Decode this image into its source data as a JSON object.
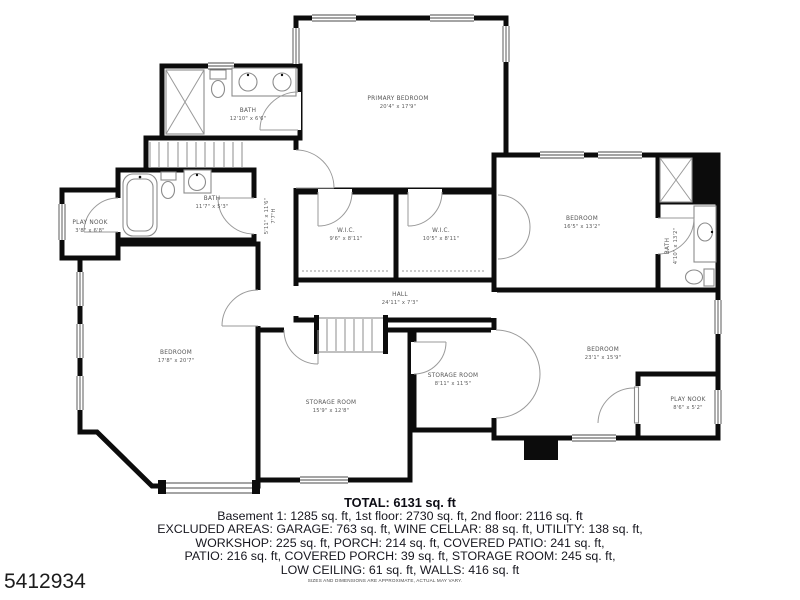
{
  "plan": {
    "wall_color": "#0c0c0c",
    "rooms": [
      {
        "name": "PRIMARY BEDROOM",
        "dims": "20'4\" x 17'9\""
      },
      {
        "name": "BATH",
        "dims": "12'10\" x 6'6\""
      },
      {
        "name": "BATH",
        "dims": "11'7\" x 5'3\""
      },
      {
        "name": "PLAY NOOK",
        "dims": "3'8\" x 6'8\""
      },
      {
        "name": "W.I.C.",
        "dims": "9'6\" x 8'11\""
      },
      {
        "name": "W.I.C.",
        "dims": "10'5\" x 8'11\""
      },
      {
        "name": "HALL",
        "dims": "24'11\" x 7'3\""
      },
      {
        "name": "BEDROOM",
        "dims": "16'5\" x 13'2\""
      },
      {
        "name": "BATH",
        "dims": "4'10\" x 13'2\""
      },
      {
        "name": "BEDROOM",
        "dims": "17'8\" x 20'7\""
      },
      {
        "name": "STORAGE ROOM",
        "dims": "15'9\" x 12'8\""
      },
      {
        "name": "STORAGE ROOM",
        "dims": "8'11\" x 11'5\""
      },
      {
        "name": "BEDROOM",
        "dims": "23'1\" x 15'9\""
      },
      {
        "name": "PLAY NOOK",
        "dims": "8'6\" x 5'2\""
      }
    ],
    "stair_note": {
      "line1": "5'11\" x 11'6\"",
      "line2": "7'7\"H"
    }
  },
  "summary": {
    "total": "TOTAL: 6131 sq. ft",
    "lines": [
      "Basement 1: 1285 sq. ft, 1st floor: 2730 sq. ft, 2nd floor: 2116 sq. ft",
      "EXCLUDED AREAS: GARAGE: 763 sq. ft, WINE CELLAR: 88 sq. ft, UTILITY: 138 sq. ft,",
      "WORKSHOP: 225 sq. ft, PORCH: 214 sq. ft, COVERED PATIO: 241 sq. ft,",
      "PATIO: 216 sq. ft, COVERED PORCH: 39 sq. ft, STORAGE ROOM: 245 sq. ft,",
      "LOW CEILING: 61 sq. ft, WALLS: 416 sq. ft"
    ],
    "disclaimer": "SIZES AND DIMENSIONS ARE APPROXIMATE, ACTUAL MAY VARY."
  },
  "watermark_id": "5412934"
}
